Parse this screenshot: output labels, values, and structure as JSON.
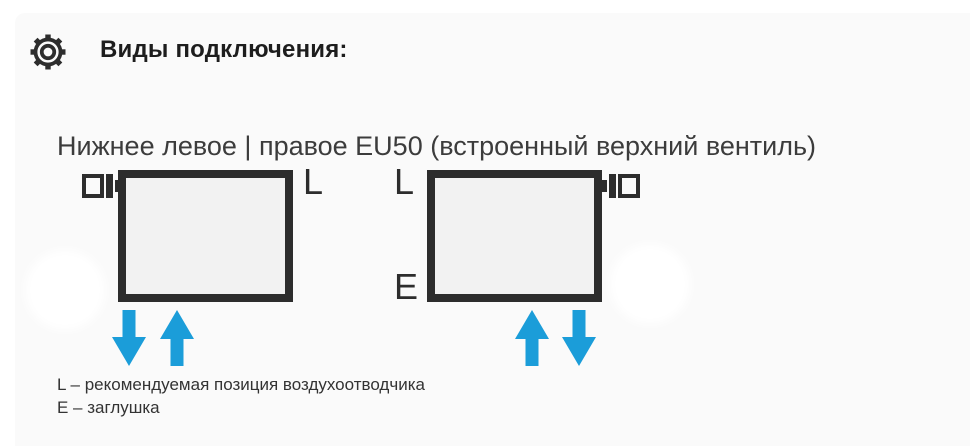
{
  "header": {
    "icon": "gear",
    "title": "Виды подключения:"
  },
  "subtitle": "Нижнее левое | правое EU50 (встроенный верхний вентиль)",
  "diagrams": [
    {
      "id": "bottom-left-connection",
      "valve_position": "top-left",
      "air_vent_label": "L",
      "arrows": [
        "down",
        "up"
      ]
    },
    {
      "id": "bottom-right-connection",
      "valve_position": "top-right",
      "air_vent_label": "L",
      "plug_label": "E",
      "arrows": [
        "up",
        "down"
      ]
    }
  ],
  "legend": [
    "L – рекомендуемая позиция воздухоотводчика",
    "E – заглушка"
  ],
  "colors": {
    "accent_blue": "#1b9dd9",
    "outline_dark": "#2d2d2d",
    "radiator_fill": "#f2f2f2",
    "panel_background": "#fafafa"
  }
}
